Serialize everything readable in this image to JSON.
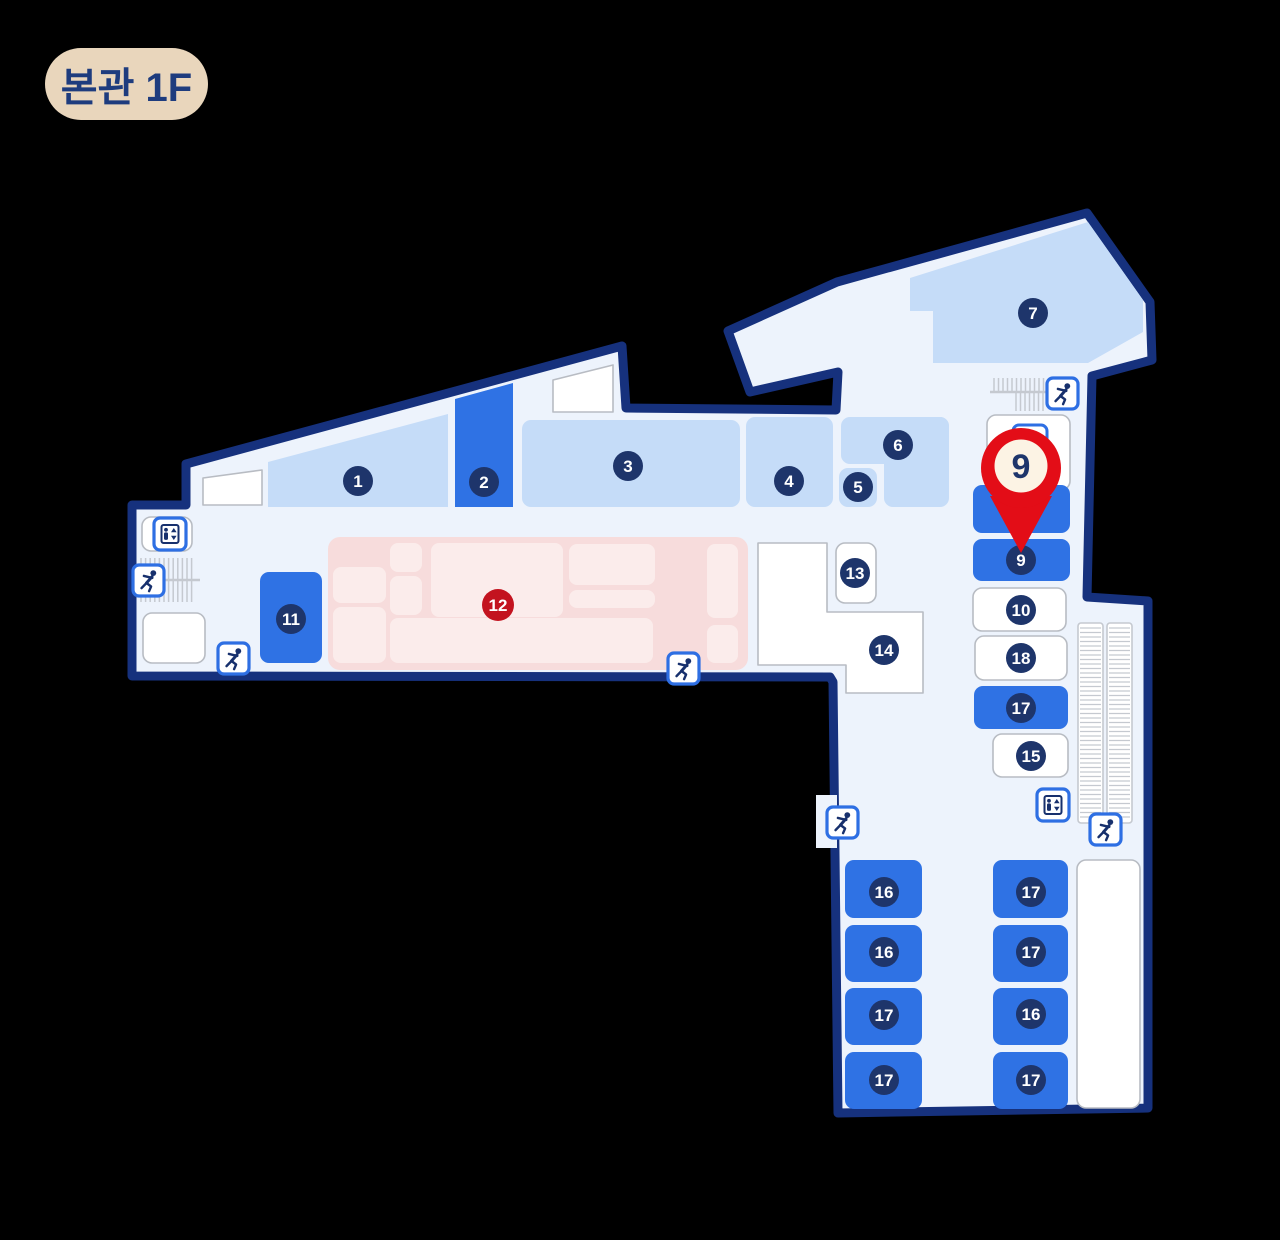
{
  "badge": {
    "label": "본관 1F",
    "bg": "#e9d6bc",
    "text_color": "#1e3c7e"
  },
  "colors": {
    "background": "#000000",
    "floor": "#edf3fc",
    "outline": "#16317d",
    "room_light": "#c5dcf8",
    "room_highlight": "#2f72e4",
    "room_white": "#ffffff",
    "room_white_border": "#b8bcc3",
    "pink_area": "#f7dcdc",
    "pink_sub": "#fbeceb",
    "circle_navy": "#1e356b",
    "circle_red": "#c3131f",
    "icon_border": "#2e6fe3",
    "icon_glyph": "#17306d",
    "stair_gray": "#c5c9d0",
    "pin_red": "#e30d17",
    "pin_inner": "#fcf3e4",
    "pin_text": "#1e356b"
  },
  "map": {
    "rooms": [
      {
        "number": "1",
        "style": "light",
        "poly": [
          [
            268,
            462
          ],
          [
            448,
            414
          ],
          [
            448,
            507
          ],
          [
            268,
            507
          ]
        ],
        "cx": 358,
        "cy": 481
      },
      {
        "number": "2",
        "style": "highlight",
        "poly": [
          [
            455,
            399
          ],
          [
            513,
            383
          ],
          [
            513,
            507
          ],
          [
            455,
            507
          ]
        ],
        "cx": 484,
        "cy": 482
      },
      {
        "number": "3",
        "style": "light",
        "rect": [
          522,
          420,
          218,
          87
        ],
        "cx": 628,
        "cy": 466
      },
      {
        "number": "4",
        "style": "light",
        "rect": [
          746,
          417,
          87,
          90
        ],
        "cx": 789,
        "cy": 481
      },
      {
        "number": "5",
        "style": "light",
        "rect": [
          839,
          468,
          38,
          39
        ],
        "cx": 858,
        "cy": 487
      },
      {
        "number": "6",
        "style": "light",
        "rects": [
          [
            841,
            417,
            108,
            47
          ],
          [
            884,
            417,
            65,
            90
          ]
        ],
        "cx": 898,
        "cy": 445
      },
      {
        "number": "7",
        "style": "light",
        "poly": [
          [
            910,
            278
          ],
          [
            1088,
            222
          ],
          [
            1143,
            300
          ],
          [
            1143,
            332
          ],
          [
            1088,
            363
          ],
          [
            933,
            363
          ],
          [
            933,
            311
          ],
          [
            910,
            311
          ]
        ],
        "cx": 1033,
        "cy": 313
      },
      {
        "number": "9",
        "style": "highlight",
        "rect": [
          973,
          539,
          97,
          42
        ],
        "cx": 1021,
        "cy": 560
      },
      {
        "number": "10",
        "style": "white",
        "rect": [
          973,
          588,
          93,
          43
        ],
        "cx": 1021,
        "cy": 610
      },
      {
        "number": "11",
        "style": "highlight",
        "rect": [
          260,
          572,
          62,
          91
        ],
        "cx": 291,
        "cy": 619
      },
      {
        "number": "13",
        "style": "white",
        "rect": [
          836,
          543,
          40,
          60
        ],
        "cx": 855,
        "cy": 573
      },
      {
        "number": "14",
        "style": "white",
        "poly": [
          [
            758,
            543
          ],
          [
            827,
            543
          ],
          [
            827,
            612
          ],
          [
            923,
            612
          ],
          [
            923,
            693
          ],
          [
            846,
            693
          ],
          [
            846,
            665
          ],
          [
            758,
            665
          ]
        ],
        "cx": 884,
        "cy": 650
      },
      {
        "number": "15",
        "style": "white",
        "rect": [
          993,
          734,
          75,
          43
        ],
        "cx": 1031,
        "cy": 756
      },
      {
        "number": "17",
        "style": "highlight",
        "rect": [
          974,
          686,
          94,
          43
        ],
        "cx": 1021,
        "cy": 708
      },
      {
        "number": "18",
        "style": "white",
        "rect": [
          975,
          636,
          92,
          44
        ],
        "cx": 1021,
        "cy": 658
      },
      {
        "number": "16",
        "style": "highlight",
        "rect": [
          845,
          860,
          77,
          58
        ],
        "cx": 884,
        "cy": 892
      },
      {
        "number": "16",
        "style": "highlight",
        "rect": [
          845,
          925,
          77,
          57
        ],
        "cx": 884,
        "cy": 952
      },
      {
        "number": "17",
        "style": "highlight",
        "rect": [
          845,
          988,
          77,
          57
        ],
        "cx": 884,
        "cy": 1015
      },
      {
        "number": "17",
        "style": "highlight",
        "rect": [
          845,
          1052,
          77,
          57
        ],
        "cx": 884,
        "cy": 1080
      },
      {
        "number": "17",
        "style": "highlight",
        "rect": [
          993,
          860,
          75,
          58
        ],
        "cx": 1031,
        "cy": 892
      },
      {
        "number": "17",
        "style": "highlight",
        "rect": [
          993,
          925,
          75,
          57
        ],
        "cx": 1031,
        "cy": 952
      },
      {
        "number": "16",
        "style": "highlight",
        "rect": [
          993,
          988,
          75,
          57
        ],
        "cx": 1031,
        "cy": 1014
      },
      {
        "number": "17",
        "style": "highlight",
        "rect": [
          993,
          1052,
          75,
          57
        ],
        "cx": 1031,
        "cy": 1080
      }
    ],
    "areas": [
      {
        "name": "room-unlabeled-left",
        "style": "white",
        "poly": [
          [
            203,
            478
          ],
          [
            262,
            470
          ],
          [
            262,
            505
          ],
          [
            203,
            505
          ]
        ]
      },
      {
        "name": "room-unlabeled-top",
        "style": "white",
        "poly": [
          [
            553,
            380
          ],
          [
            613,
            365
          ],
          [
            613,
            412
          ],
          [
            553,
            412
          ]
        ]
      },
      {
        "name": "room-8-box",
        "style": "white",
        "rect": [
          987,
          415,
          83,
          75
        ]
      },
      {
        "name": "room-unlabeled-bottomleft",
        "style": "white",
        "rect": [
          143,
          613,
          62,
          50
        ]
      },
      {
        "name": "room-unlabeled-strip",
        "style": "white",
        "rect": [
          1077,
          860,
          63,
          248
        ]
      },
      {
        "name": "elevator-outer-box",
        "style": "white",
        "rect": [
          142,
          517,
          50,
          34
        ]
      },
      {
        "name": "room-highlight-under-pin",
        "style": "highlight",
        "rect": [
          973,
          485,
          97,
          48
        ]
      }
    ],
    "pink_area": {
      "number": "12",
      "cx": 498,
      "cy": 605,
      "rect": [
        328,
        537,
        420,
        133
      ],
      "subs": [
        [
          333,
          567,
          53,
          36
        ],
        [
          333,
          607,
          53,
          56
        ],
        [
          390,
          543,
          32,
          29
        ],
        [
          390,
          576,
          32,
          39
        ],
        [
          431,
          543,
          132,
          74
        ],
        [
          390,
          618,
          263,
          45
        ],
        [
          569,
          544,
          86,
          41
        ],
        [
          569,
          590,
          86,
          18
        ],
        [
          707,
          544,
          31,
          74
        ],
        [
          707,
          625,
          31,
          38
        ]
      ]
    },
    "icons": [
      {
        "name": "stairs-icon",
        "x": 133,
        "y": 565
      },
      {
        "name": "stairs-icon",
        "x": 218,
        "y": 643
      },
      {
        "name": "stairs-icon",
        "x": 668,
        "y": 653
      },
      {
        "name": "stairs-icon",
        "x": 1047,
        "y": 378
      },
      {
        "name": "stairs-icon",
        "x": 827,
        "y": 807
      },
      {
        "name": "stairs-icon",
        "x": 1090,
        "y": 814
      },
      {
        "name": "elevator-icon",
        "x": 154,
        "y": 518
      },
      {
        "name": "elevator-icon",
        "x": 1037,
        "y": 789
      }
    ],
    "pin": {
      "label": "9",
      "x": 1021,
      "y": 468,
      "tip_y": 553
    }
  }
}
